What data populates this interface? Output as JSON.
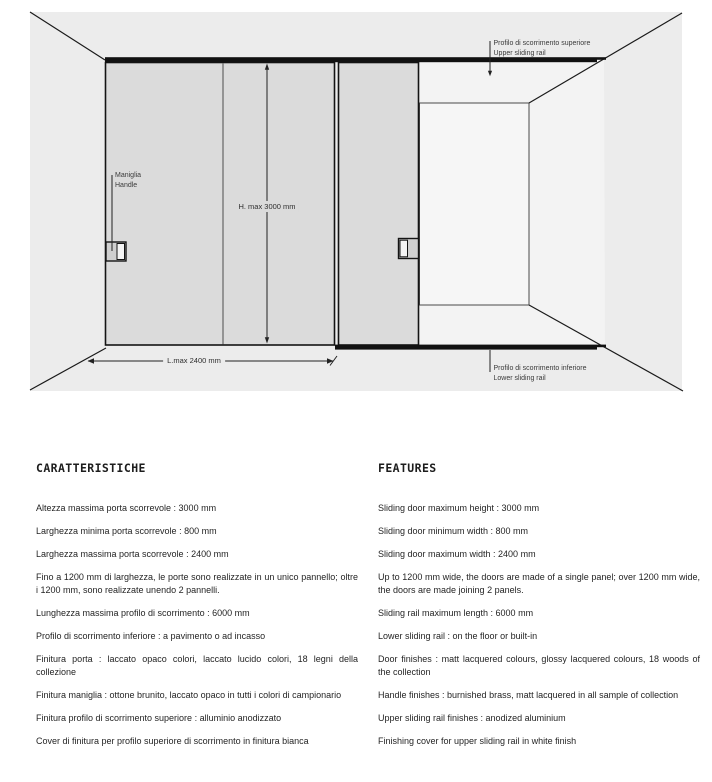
{
  "diagram": {
    "labels": {
      "upper_rail": {
        "it": "Profilo di scorrimento superiore",
        "en": "Upper sliding rail"
      },
      "lower_rail": {
        "it": "Profilo di scorrimento inferiore",
        "en": "Lower sliding rail"
      },
      "handle": {
        "it": "Maniglia",
        "en": "Handle"
      },
      "max_height": "H. max 3000 mm",
      "max_length": "L.max 2400 mm"
    },
    "colors": {
      "wall": "#ECECEC",
      "opening": "#F3F3F3",
      "back_wall": "#F6F6F6",
      "door": "#DBDBDB",
      "handle_body": "#CFCFCF",
      "handle_strip": "#F4F4F4",
      "rail": "#111111"
    }
  },
  "specs": {
    "caratteristiche": {
      "title": "CARATTERISTICHE",
      "items": [
        "Altezza massima porta scorrevole : 3000 mm",
        "Larghezza minima porta scorrevole : 800 mm",
        "Larghezza massima porta scorrevole : 2400 mm",
        "Fino a 1200 mm di larghezza, le porte sono realizzate in un unico pannello; oltre i 1200 mm, sono realizzate unendo 2 pannelli.",
        "Lunghezza massima profilo di scorrimento : 6000 mm",
        "Profilo di scorrimento inferiore : a pavimento o ad incasso",
        "Finitura porta : laccato opaco colori, laccato lucido colori, 18 legni della collezione",
        "Finitura maniglia : ottone brunito, laccato opaco in tutti i colori di campionario",
        "Finitura profilo di scorrimento superiore : alluminio anodizzato",
        "Cover di finitura per profilo superiore di scorrimento in finitura bianca"
      ]
    },
    "features": {
      "title": "FEATURES",
      "items": [
        "Sliding door maximum height : 3000 mm",
        "Sliding door minimum width : 800 mm",
        "Sliding door maximum width : 2400 mm",
        "Up to 1200 mm wide, the doors are made of a single panel; over 1200 mm wide, the doors are made joining 2 panels.",
        "Sliding rail maximum length : 6000 mm",
        "Lower sliding rail : on the floor or built-in",
        "Door finishes : matt lacquered colours, glossy lacquered colours, 18 woods of the collection",
        "Handle finishes : burnished brass, matt lacquered in all sample of collection",
        "Upper sliding rail finishes : anodized aluminium",
        "Finishing cover for upper sliding rail in white finish"
      ]
    }
  }
}
